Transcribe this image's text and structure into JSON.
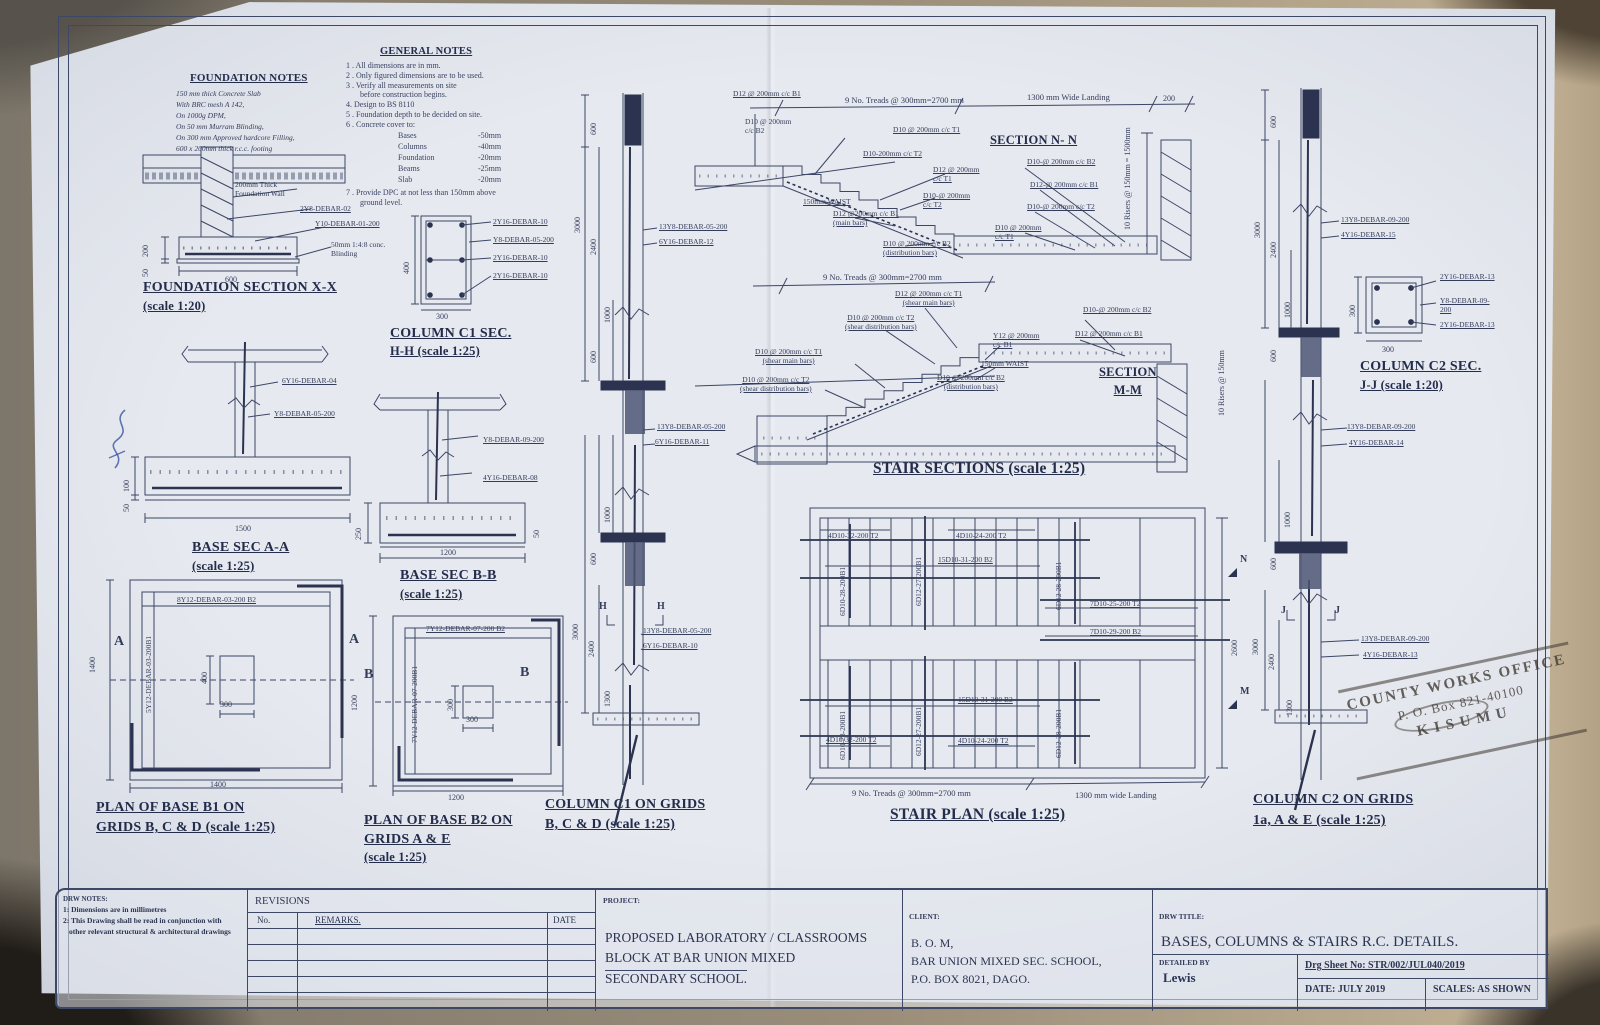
{
  "fnotes": {
    "title": "FOUNDATION  NOTES",
    "lines": [
      "150 mm thick Concrete Slab",
      "With BRC mesh A 142,",
      "On 1000g DPM,",
      "On 50 mm Murram Blinding,",
      "On 300 mm Approved hardcore Filling,",
      "600 x 200mm thick  r.c.c. footing"
    ]
  },
  "gnotes": {
    "title": "GENERAL  NOTES",
    "n1": "1 . All dimensions are in mm.",
    "n2": "2 . Only figured dimensions are to be used.",
    "n3": "3 . Verify all measurements on site",
    "n3b": "before construction begins.",
    "n4": "4.   Design  to  BS 8110",
    "n5": "5 . Foundation depth to be decided on site.",
    "n6": "6 . Concrete  cover  to:",
    "cov": [
      [
        "Bases",
        "-50mm"
      ],
      [
        "Columns",
        "-40mm"
      ],
      [
        "Foundation",
        "-20mm"
      ],
      [
        "Beams",
        "-25mm"
      ],
      [
        "Slab",
        "-20mm"
      ]
    ],
    "n7": "7 . Provide DPC at not less than 150mm above",
    "n7b": "ground level."
  },
  "fsec": {
    "title": "FOUNDATION  SECTION  X-X",
    "scale": "(scale  1:20)",
    "wall": "200mm Thick\nFoundation Wall",
    "bar1": "2Y8-DEBAR-02",
    "bar2": "Y10-DEBAR-01-200",
    "blind": "50mm 1:4:8 conc.\nBlinding",
    "d600": "600",
    "d200": "200",
    "d50": "50"
  },
  "c1sec": {
    "title": "COLUMN  C1  SEC.",
    "scale": "H-H  (scale  1:25)",
    "b1": "2Y16-DEBAR-10",
    "b2": "Y8-DEBAR-05-200",
    "b3": "2Y16-DEBAR-10",
    "b4": "2Y16-DEBAR-10",
    "d400": "400",
    "d300": "300"
  },
  "baa": {
    "title": "BASE  SEC  A-A",
    "scale": "(scale  1:25)",
    "b1": "6Y16-DEBAR-04",
    "b2": "Y8-DEBAR-05-200",
    "d1500": "1500",
    "d100": "100",
    "d50": "50"
  },
  "bbb": {
    "title": "BASE  SEC  B-B",
    "scale": "(scale  1:25)",
    "b1": "Y8-DEBAR-09-200",
    "b2": "4Y16-DEBAR-08",
    "d1200": "1200",
    "d250": "250",
    "d50": "50"
  },
  "pb1": {
    "t1": "PLAN OF BASE  B1  ON",
    "t2": "GRIDS  B,  C  &  D  (scale 1:25)",
    "top": "8Y12-DEBAR-03-200 B2",
    "side": "5Y12-DEBAR-03-200B1",
    "mk": "A",
    "d1400a": "1400",
    "d1400b": "1400",
    "d400": "400",
    "d300": "300"
  },
  "pb2": {
    "t1": "PLAN OF BASE  B2  ON",
    "t2": "GRIDS  A  &  E",
    "t3": "(scale  1:25)",
    "top": "7Y12-DEBAR-07-200 B2",
    "side": "7Y12-DEBAR-07-200B1",
    "mk": "B",
    "d1200a": "1200",
    "d1200b": "1200",
    "d300a": "300",
    "d300b": "300"
  },
  "c1": {
    "t1": "COLUMN  C1  ON  GRIDS",
    "t2": "B,  C  &  D  (scale  1:25)",
    "mk": "H",
    "u1": "13Y8-DEBAR-05-200",
    "u2": "6Y16-DEBAR-12",
    "m1": "13Y8-DEBAR-05-200",
    "m2": "6Y16-DEBAR-11",
    "l1": "13Y8-DEBAR-05-200",
    "l2": "6Y16-DEBAR-10",
    "t600": "600",
    "a3000": "3000",
    "a2400": "2400",
    "a1000": "1000",
    "a600": "600",
    "b1000": "1000",
    "b600": "600",
    "c3000": "3000",
    "c2400": "2400",
    "c1300": "1300"
  },
  "nn": {
    "name": "SECTION  N- N",
    "b1": "D12 @ 200mm c/c B1",
    "b2": "D10  @ 200mm\nc/c B2",
    "treads": "9 No. Treads @ 300mm=2700 mm",
    "landing": "1300 mm Wide Landing",
    "d200": "200",
    "t1a": "D10 @ 200mm c/c T1",
    "t2a": "D10-200mm c/c T2",
    "t1b": "D12 @ 200mm\nc/c T1",
    "t2b": "D10-@ 200mm\nc/c T2",
    "rb2": "D10-@ 200mm c/c B2",
    "rb1": "D12-@ 200mm c/c B1",
    "rt2": "D10-@ 200mm c/c T2",
    "rt1": "D10 @ 200mm\nc/c T1",
    "waist": "150mm WAIST",
    "main": "D12 @200mm c/c B1\n(main bars)",
    "dist": "D10 @ 200mm c/c B2\n(distribution bars)",
    "risers": "10 Risers @ 150mm\n= 1500mm"
  },
  "mm": {
    "name": "SECTION\nM-M",
    "treads": "9 No. Treads @ 300mm=2700 mm",
    "t1a": "D12 @ 200mm c/c T1\n(shear main bars)",
    "t2a": "D10 @ 200mm c/c T2\n(shear distribution bars)",
    "yb1": "Y12 @ 200mm\nc/c B1",
    "waist": "150mm WAIST",
    "t1b": "D10 @ 200mm c/c T1\n(shear main bars)",
    "t2b": "D10 @ 200mm c/c T2\n(shear distribution bars)",
    "dist": "D10 @ 200mm c/c B2\n(distribution bars)",
    "rb2": "D10-@ 200mm c/c B2",
    "rb1": "D12 @ 200mm c/c B1",
    "risers": "10 Risers @ 150mm"
  },
  "ssec": {
    "title": "STAIR  SECTIONS  (scale 1:25)"
  },
  "splan": {
    "title": "STAIR  PLAN  (scale 1:25)",
    "ut2l": "4D10-32-200 T2",
    "ut2r": "4D10-24-200 T2",
    "ub2": "15D10-31-200 B2",
    "uv1": "6D10-28-200B1",
    "uv2": "6D12-27-200B1",
    "uv3": "6D12 28-200B1",
    "lt2l": "4D10-32-200 T2",
    "lt2r": "4D10-24-200 T2",
    "lb2": "15D10-31-200 B2",
    "lv1": "6D10-28-200B1",
    "lv2": "6D12-27-200B1",
    "lv3": "6D12-28-200B1",
    "land1": "7D10-25-200 T2",
    "land2": "7D10-29-200 B2",
    "d2600": "2600",
    "n": "N",
    "m": "M",
    "treads": "9 No. Treads @ 300mm=2700 mm",
    "landing": "1300 mm wide Landing"
  },
  "c2": {
    "t1": "COLUMN  C2  ON  GRIDS",
    "t2": "1a,  A  &  E  (scale  1:25)",
    "mk": "J",
    "u1": "13Y8-DEBAR-09-200",
    "u2": "4Y16-DEBAR-15",
    "m1": "13Y8-DEBAR-09-200",
    "m2": "4Y16-DEBAR-14",
    "l1": "13Y8-DEBAR-09-200",
    "l2": "4Y16-DEBAR-13",
    "t600": "600",
    "a3000": "3000",
    "a2400": "2400",
    "a1000": "1000",
    "a600": "600",
    "b1000": "1000",
    "b600": "600",
    "c3000": "3000",
    "c2400": "2400",
    "c1300": "1300"
  },
  "c2sec": {
    "title": "COLUMN  C2  SEC.",
    "scale": "J-J  (scale  1:20)",
    "b1": "2Y16-DEBAR-13",
    "b2": "Y8-DEBAR-09-200",
    "b3": "2Y16-DEBAR-13",
    "d300a": "300",
    "d300b": "300"
  },
  "stamp": {
    "l1": "COUNTY WORKS OFFICE",
    "l2": "P. O. Box 821-40100",
    "l3": "KISUMU"
  },
  "tb": {
    "dn_t": "DRW NOTES:",
    "dn1": "1: Dimensions are in millimetres",
    "dn2": "2: This Drawing shall be read in conjunction with",
    "dn3": "other relevant structural &  architectural drawings",
    "rev": "REVISIONS",
    "no": "No.",
    "remarks": "REMARKS.",
    "date": "DATE",
    "proj_l": "PROJECT:",
    "p1": "PROPOSED   LABORATORY / CLASSROOMS",
    "p2": "BLOCK  AT  BAR  UNION  MIXED",
    "p3": "SECONDARY   SCHOOL.",
    "cli_l": "CLIENT:",
    "cl1": "B. O. M,",
    "cl2": "BAR UNION MIXED SEC. SCHOOL,",
    "cl3": "P.O.  BOX  8021,  DAGO.",
    "ttl_l": "DRW TITLE:",
    "ttl": "BASES,  COLUMNS  &  STAIRS  R.C.  DETAILS.",
    "det_l": "DETAILED BY",
    "det": "Lewis",
    "sheet": "Drg Sheet No:   STR/002/JUL040/2019",
    "date2": "DATE:   JULY  2019",
    "scales": "SCALES: AS SHOWN"
  }
}
